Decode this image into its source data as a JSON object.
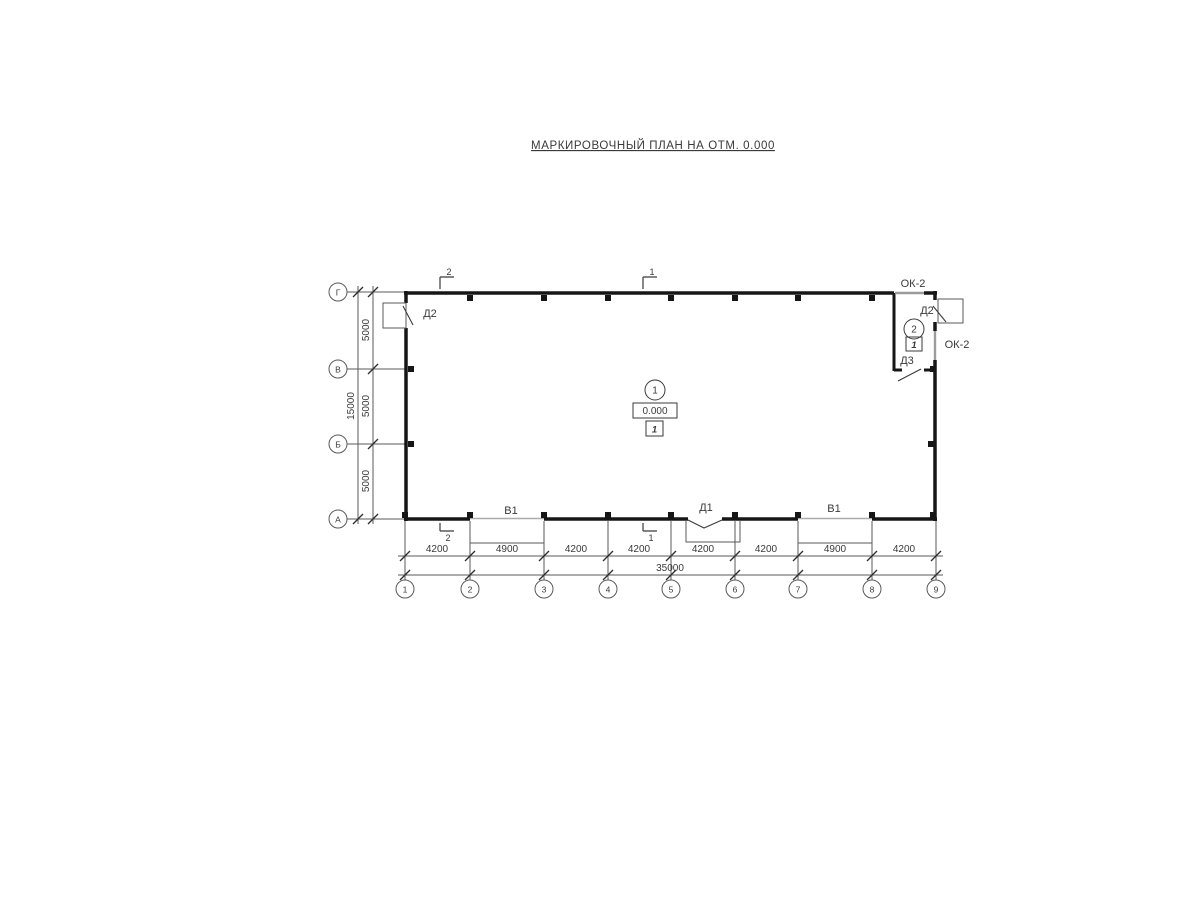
{
  "title": "МАРКИРОВОЧНЫЙ ПЛАН НА ОТМ. 0.000",
  "axes": {
    "horizontal": [
      "Г",
      "В",
      "Б",
      "А"
    ],
    "vertical": [
      "1",
      "2",
      "3",
      "4",
      "5",
      "6",
      "7",
      "8",
      "9"
    ]
  },
  "dimensions": {
    "left_total": "15000",
    "left_chain": [
      "5000",
      "5000",
      "5000"
    ],
    "bottom_chain": [
      "4200",
      "4900",
      "4200",
      "4200",
      "4200",
      "4200",
      "4900",
      "4200"
    ],
    "bottom_total": "35000"
  },
  "openings": {
    "door_left": "Д2",
    "door_right": "Д2",
    "door_inner": "Д3",
    "door_bottom": "Д1",
    "gate_left": "В1",
    "gate_right": "В1",
    "window_top": "ОК-2",
    "window_right": "ОК-2"
  },
  "rooms": {
    "hall": {
      "number": "1",
      "elevation": "0.000",
      "floor_mark": "1"
    },
    "annex": {
      "number": "2",
      "floor_mark": "1"
    }
  },
  "section_marks": {
    "s1": "1",
    "s2": "2"
  }
}
